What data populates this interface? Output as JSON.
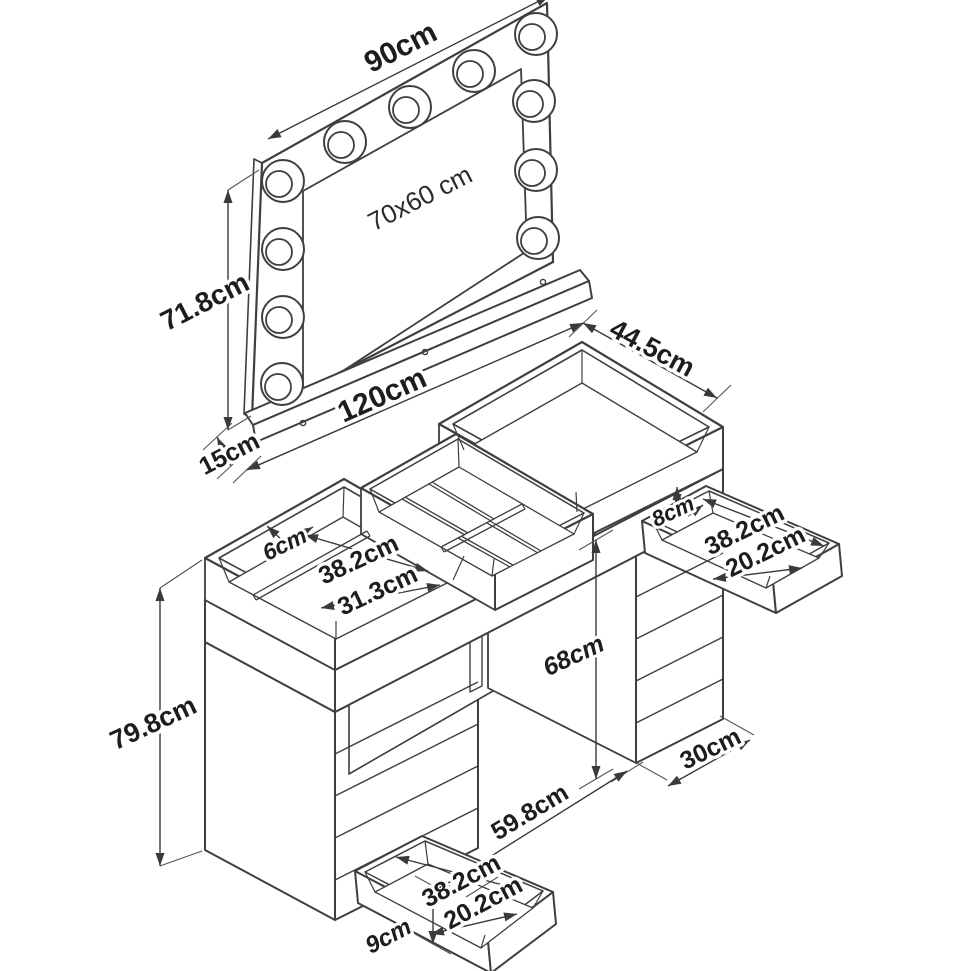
{
  "drawing": {
    "kind": "furniture dimension diagram",
    "units": "cm"
  },
  "labels": {
    "mirror_width": "90cm",
    "mirror_glass_size": "70x60 cm",
    "mirror_height": "71.8cm",
    "mirror_base_depth": "15cm",
    "table_width": "120cm",
    "table_depth": "44.5cm",
    "left_tray_depth": "6cm",
    "left_compartment_width": "38.2cm",
    "left_compartment_depth": "31.3cm",
    "right_drawer_height": "8cm",
    "right_drawer_width": "38.2cm",
    "right_drawer_depth": "20.2cm",
    "kneehole_height": "68cm",
    "right_pedestal_width": "30cm",
    "table_height": "79.8cm",
    "kneehole_width": "59.8cm",
    "bottom_drawer_width": "38.2cm",
    "bottom_drawer_depth": "20.2cm",
    "bottom_drawer_height": "9cm"
  },
  "colors": {
    "line": "#3f3f3f",
    "label": "#1d1d1d",
    "background": "#ffffff"
  }
}
